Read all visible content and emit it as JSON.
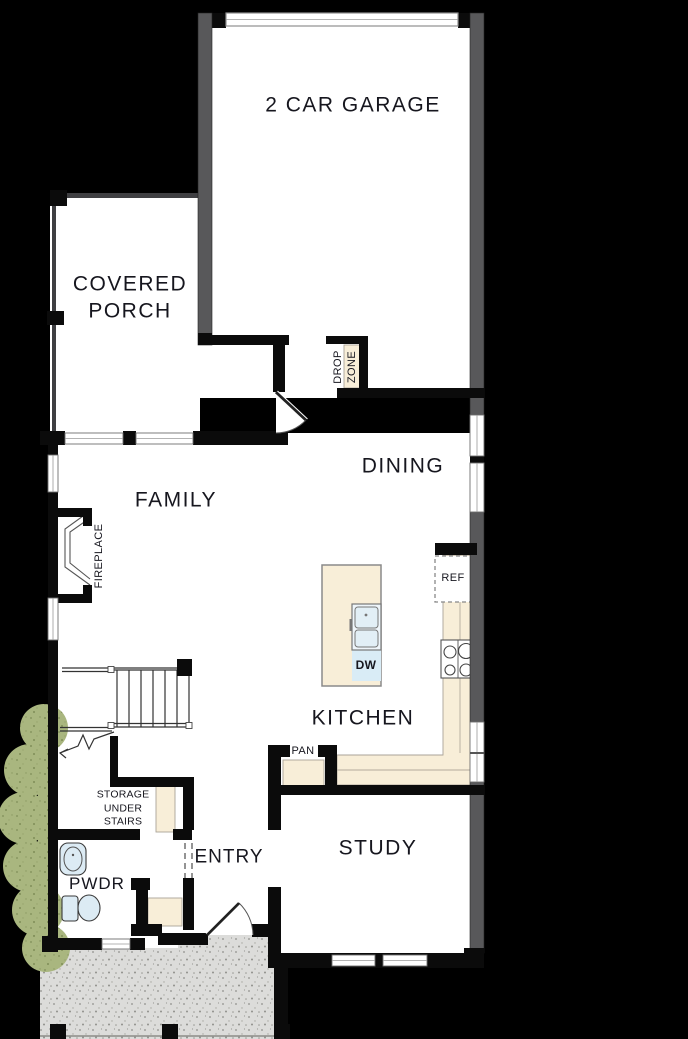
{
  "plan": {
    "rooms": {
      "garage": "2 CAR GARAGE",
      "covered_porch": "COVERED\nPORCH",
      "family": "FAMILY",
      "dining": "DINING",
      "kitchen": "KITCHEN",
      "study": "STUDY",
      "entry": "ENTRY",
      "powder": "PWDR"
    },
    "features": {
      "drop_zone_word1": "DROP",
      "drop_zone_word2": "ZONE",
      "fireplace": "FIREPLACE",
      "storage_under_stairs": "STORAGE\nUNDER\nSTAIRS",
      "pantry": "PAN",
      "refrigerator": "REF",
      "dishwasher": "DW"
    },
    "colors": {
      "background": "#000000",
      "floor": "#ffffff",
      "wall": "#0b0b0b",
      "garage_wall": "#58585a",
      "counter": "#f8eed8",
      "fixture_blue": "#dcebf4",
      "dw_blue": "#d9ecf6",
      "shrub_green": "#a9b67f",
      "concrete": "#dcdcda",
      "label": "#16161e"
    }
  }
}
